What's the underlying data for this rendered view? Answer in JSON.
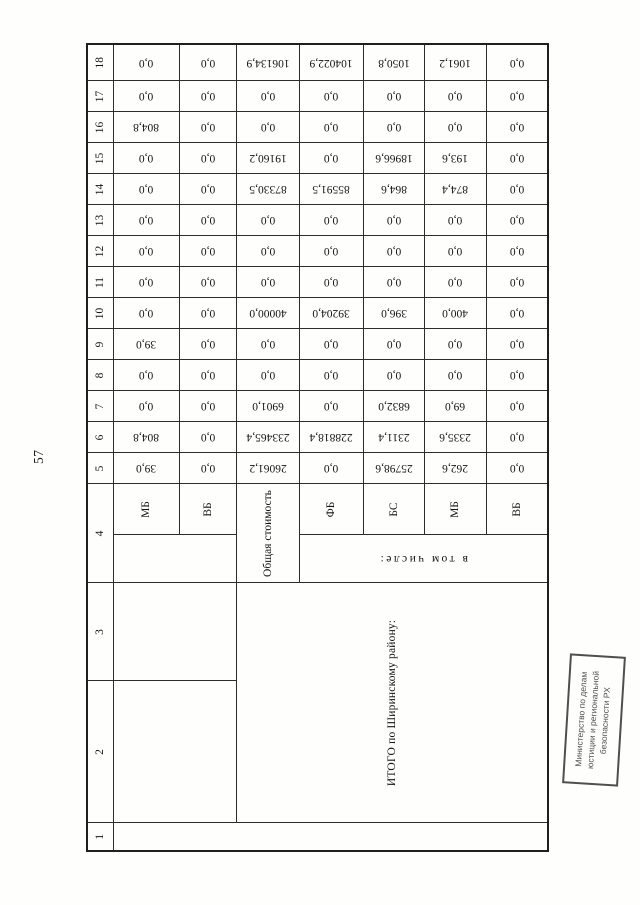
{
  "page": {
    "number": "57"
  },
  "stamp": {
    "line1": "Министерство по делам",
    "line2": "юстиции и региональной",
    "line3": "безопасности РХ"
  },
  "colors": {
    "ink": "#141414",
    "line": "#2c2c2c",
    "line_strong": "#1f1f1f",
    "stamp": "#4f4f4f"
  },
  "table": {
    "column_numbers": [
      "1",
      "2",
      "3",
      "4",
      "5",
      "6",
      "7",
      "8",
      "9",
      "10",
      "11",
      "12",
      "13",
      "14",
      "15",
      "16",
      "17",
      "18"
    ],
    "row_group_label": "ИТОГО по Ширинскому району:",
    "including_label": "в том числе:",
    "rows": [
      {
        "label": "МБ",
        "values": [
          "39,0",
          "804,8",
          "0,0",
          "0,0",
          "39,0",
          "0,0",
          "0,0",
          "0,0",
          "0,0",
          "0,0",
          "0,0",
          "804,8",
          "0,0",
          "0,0"
        ]
      },
      {
        "label": "ВБ",
        "values": [
          "0,0",
          "0,0",
          "0,0",
          "0,0",
          "0,0",
          "0,0",
          "0,0",
          "0,0",
          "0,0",
          "0,0",
          "0,0",
          "0,0",
          "0,0",
          "0,0"
        ]
      },
      {
        "label": "Общая стоимость",
        "values": [
          "26061,2",
          "233465,4",
          "6901,0",
          "0,0",
          "0,0",
          "40000,0",
          "0,0",
          "0,0",
          "0,0",
          "87330,5",
          "19160,2",
          "0,0",
          "0,0",
          "106134,9"
        ]
      },
      {
        "label": "ФБ",
        "values": [
          "0,0",
          "228818,4",
          "0,0",
          "0,0",
          "0,0",
          "39204,0",
          "0,0",
          "0,0",
          "0,0",
          "85591,5",
          "0,0",
          "0,0",
          "0,0",
          "104022,9"
        ]
      },
      {
        "label": "БС",
        "values": [
          "25798,6",
          "2311,4",
          "6832,0",
          "0,0",
          "0,0",
          "396,0",
          "0,0",
          "0,0",
          "0,0",
          "864,6",
          "18966,6",
          "0,0",
          "0,0",
          "1050,8"
        ]
      },
      {
        "label": "МБ",
        "values": [
          "262,6",
          "2335,6",
          "69,0",
          "0,0",
          "0,0",
          "400,0",
          "0,0",
          "0,0",
          "0,0",
          "874,4",
          "193,6",
          "0,0",
          "0,0",
          "1061,2"
        ]
      },
      {
        "label": "ВБ",
        "values": [
          "0,0",
          "0,0",
          "0,0",
          "0,0",
          "0,0",
          "0,0",
          "0,0",
          "0,0",
          "0,0",
          "0,0",
          "0,0",
          "0,0",
          "0,0",
          "0,0"
        ]
      }
    ]
  }
}
